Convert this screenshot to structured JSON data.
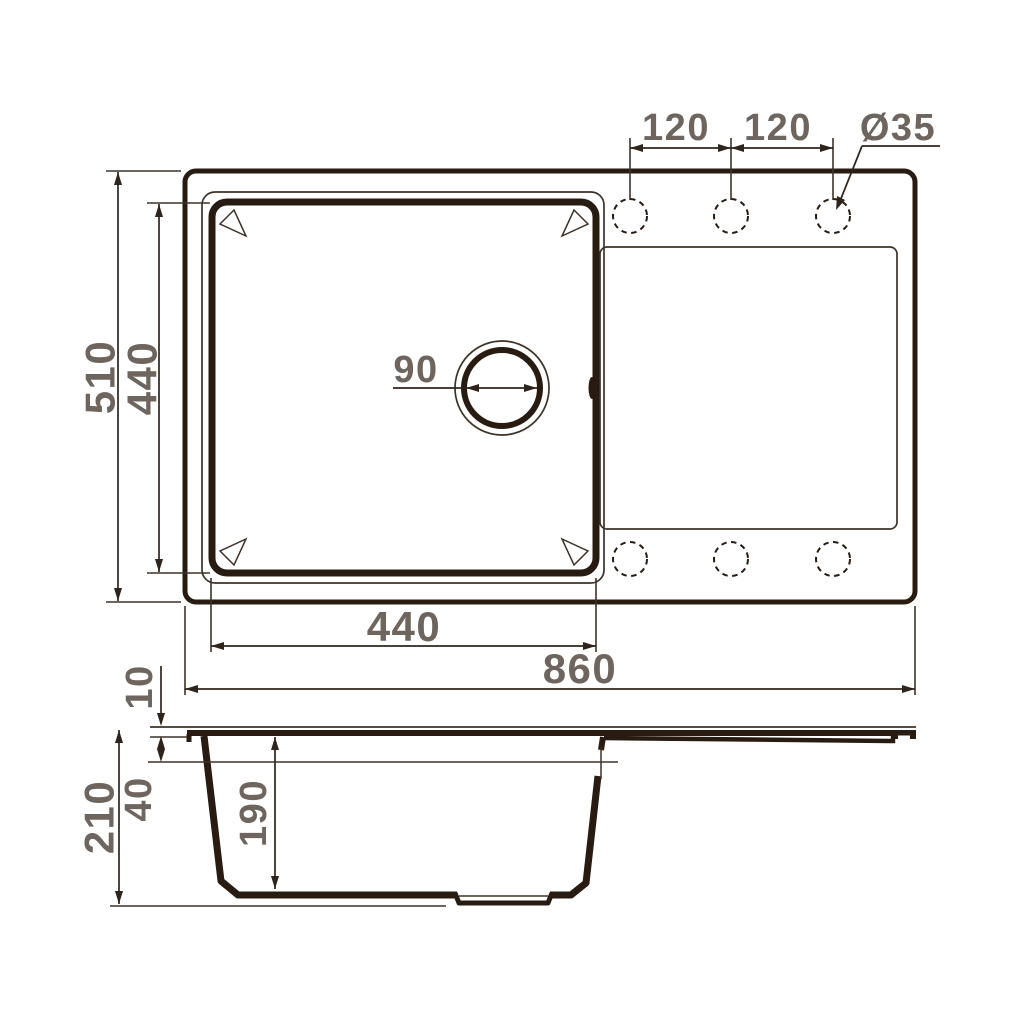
{
  "title": "Kitchen sink technical drawing",
  "colors": {
    "line": "#281c12",
    "thin_line": "#3e3228",
    "dim_line": "#2f241c",
    "dim_text": "#6d655e",
    "background": "#ffffff"
  },
  "top_view": {
    "name": "top view",
    "faucet_holes_count": 6,
    "dimensions": {
      "overall_depth": "510",
      "bowl_depth": "440",
      "hole_spacing_left": "120",
      "hole_spacing_right": "120",
      "hole_diameter": "Ø35",
      "drain_diameter": "90",
      "bowl_width": "440",
      "overall_length": "860"
    }
  },
  "side_view": {
    "name": "side view",
    "dimensions": {
      "rim_height": "10",
      "overall_height": "210",
      "upper_depth": "40",
      "bowl_depth": "190"
    }
  }
}
